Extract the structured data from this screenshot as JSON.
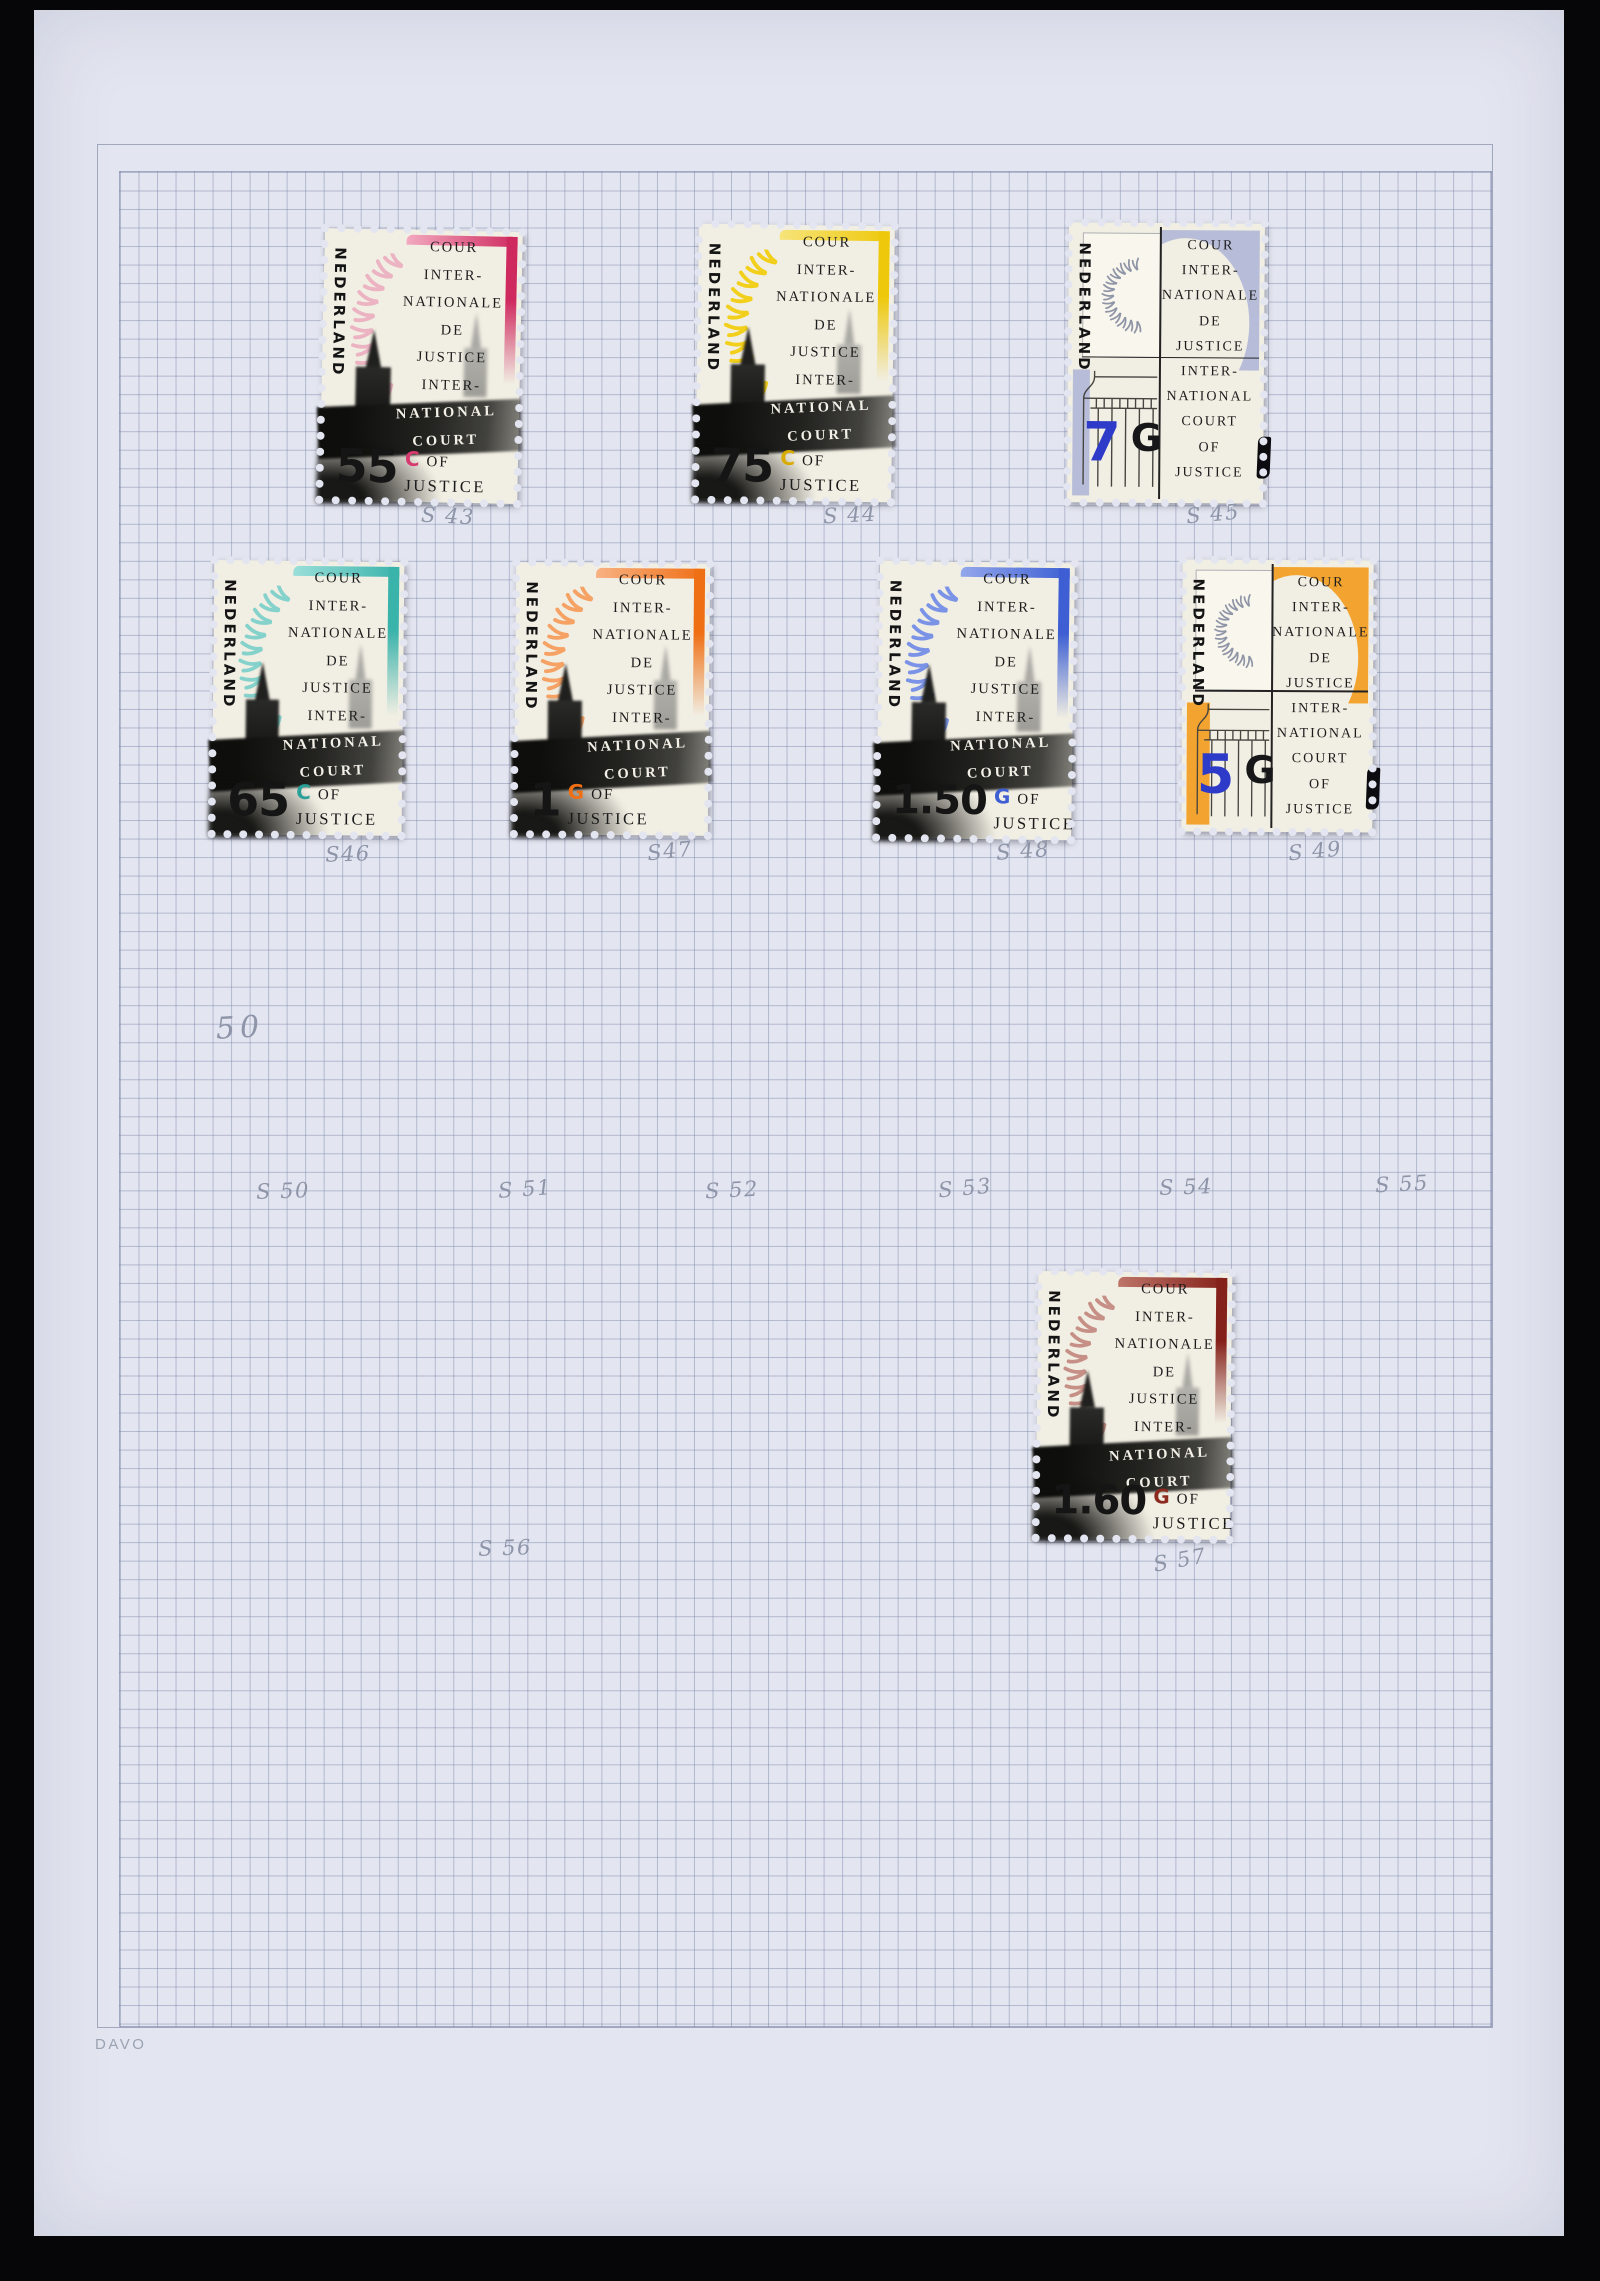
{
  "page": {
    "brand": "DAVO",
    "background": "#e3e5f0",
    "grid_line": "#7480a4",
    "pencil_color": "#8e95a8"
  },
  "stamp_text": {
    "country": "NEDERLAND",
    "lines_top": [
      "COUR",
      "INTER-",
      "NATIONALE",
      "DE",
      "JUSTICE",
      "INTER-"
    ],
    "lines_band": [
      "NATIONAL",
      "COURT"
    ],
    "of": "OF",
    "justice": "JUSTICE"
  },
  "stamps": [
    {
      "design": "towers",
      "value": "55",
      "currency": "C",
      "label": "S 43",
      "label_x": 414,
      "label_y": 506,
      "label_rot": 3,
      "x": 288,
      "y": 220,
      "w": 198,
      "h": 272,
      "tilt": 1.2,
      "colors": {
        "accent": "#cf2a60",
        "accent2": "#f2a9c0",
        "laurel": "#ecb3c2",
        "cur": "#d63a6e"
      }
    },
    {
      "design": "towers",
      "value": "75",
      "currency": "C",
      "label": "S 44",
      "label_x": 816,
      "label_y": 505,
      "label_rot": -3,
      "x": 663,
      "y": 215,
      "w": 196,
      "h": 276,
      "tilt": 0.8,
      "colors": {
        "accent": "#eec80a",
        "accent2": "#f7e47a",
        "laurel": "#f2cf1a",
        "cur": "#d9ab00"
      }
    },
    {
      "design": "column",
      "value": "7",
      "currency": "G",
      "label": "S 45",
      "label_x": 1179,
      "label_y": 504,
      "label_rot": -5,
      "x": 1034,
      "y": 213,
      "w": 196,
      "h": 280,
      "tilt": 0.4,
      "colors": {
        "accent": "#b7bdd9",
        "laurel": "#8f95a6",
        "num": "#2e3bc8"
      }
    },
    {
      "design": "towers",
      "value": "65",
      "currency": "C",
      "label": "S46",
      "label_x": 314,
      "label_y": 844,
      "label_rot": -2,
      "x": 179,
      "y": 551,
      "w": 190,
      "h": 274,
      "tilt": 0.6,
      "colors": {
        "accent": "#3ab3ab",
        "accent2": "#9adfd9",
        "laurel": "#84d2cb",
        "cur": "#2aa198"
      }
    },
    {
      "design": "towers",
      "value": "1",
      "currency": "G",
      "label": "S47",
      "label_x": 636,
      "label_y": 841,
      "label_rot": -6,
      "x": 481,
      "y": 553,
      "w": 194,
      "h": 272,
      "tilt": 0.5,
      "colors": {
        "accent": "#ef6f15",
        "accent2": "#f8b183",
        "laurel": "#f5a264",
        "cur": "#ef6f15"
      }
    },
    {
      "design": "towers",
      "value": "1.50",
      "currency": "G",
      "label": "S 48",
      "label_x": 989,
      "label_y": 841,
      "label_rot": -4,
      "x": 844,
      "y": 552,
      "w": 195,
      "h": 277,
      "tilt": 0.8,
      "colors": {
        "accent": "#3d5fd3",
        "accent2": "#93a7ec",
        "laurel": "#7a93e6",
        "cur": "#3d5fd3"
      }
    },
    {
      "design": "column",
      "value": "5",
      "currency": "G",
      "label": "S 49",
      "label_x": 1281,
      "label_y": 841,
      "label_rot": -5,
      "x": 1148,
      "y": 550,
      "w": 191,
      "h": 272,
      "tilt": 0.3,
      "band_w": "12%",
      "colors": {
        "accent": "#f3a32f",
        "laurel": "#8f95a6",
        "num": "#2e3bc8"
      }
    },
    {
      "design": "towers",
      "value": "1.60",
      "currency": "G",
      "label": "S 57",
      "label_x": 1146,
      "label_y": 1550,
      "label_rot": -10,
      "x": 1003,
      "y": 1262,
      "w": 194,
      "h": 267,
      "tilt": 0.6,
      "colors": {
        "accent": "#84211a",
        "accent2": "#bd7468",
        "laurel": "#c69087",
        "cur": "#8c2a1e"
      }
    }
  ],
  "pencil_marks": [
    {
      "text": "50",
      "x": 206,
      "y": 1018,
      "rot": -3,
      "size": 30
    },
    {
      "text": "S 50",
      "x": 249,
      "y": 1181,
      "rot": -2
    },
    {
      "text": "S 51",
      "x": 491,
      "y": 1179,
      "rot": -4
    },
    {
      "text": "S 52",
      "x": 698,
      "y": 1180,
      "rot": -3
    },
    {
      "text": "S 53",
      "x": 931,
      "y": 1178,
      "rot": -5
    },
    {
      "text": "S 54",
      "x": 1152,
      "y": 1177,
      "rot": -2
    },
    {
      "text": "S 55",
      "x": 1368,
      "y": 1174,
      "rot": -3
    },
    {
      "text": "S 56",
      "x": 471,
      "y": 1538,
      "rot": -2
    }
  ]
}
